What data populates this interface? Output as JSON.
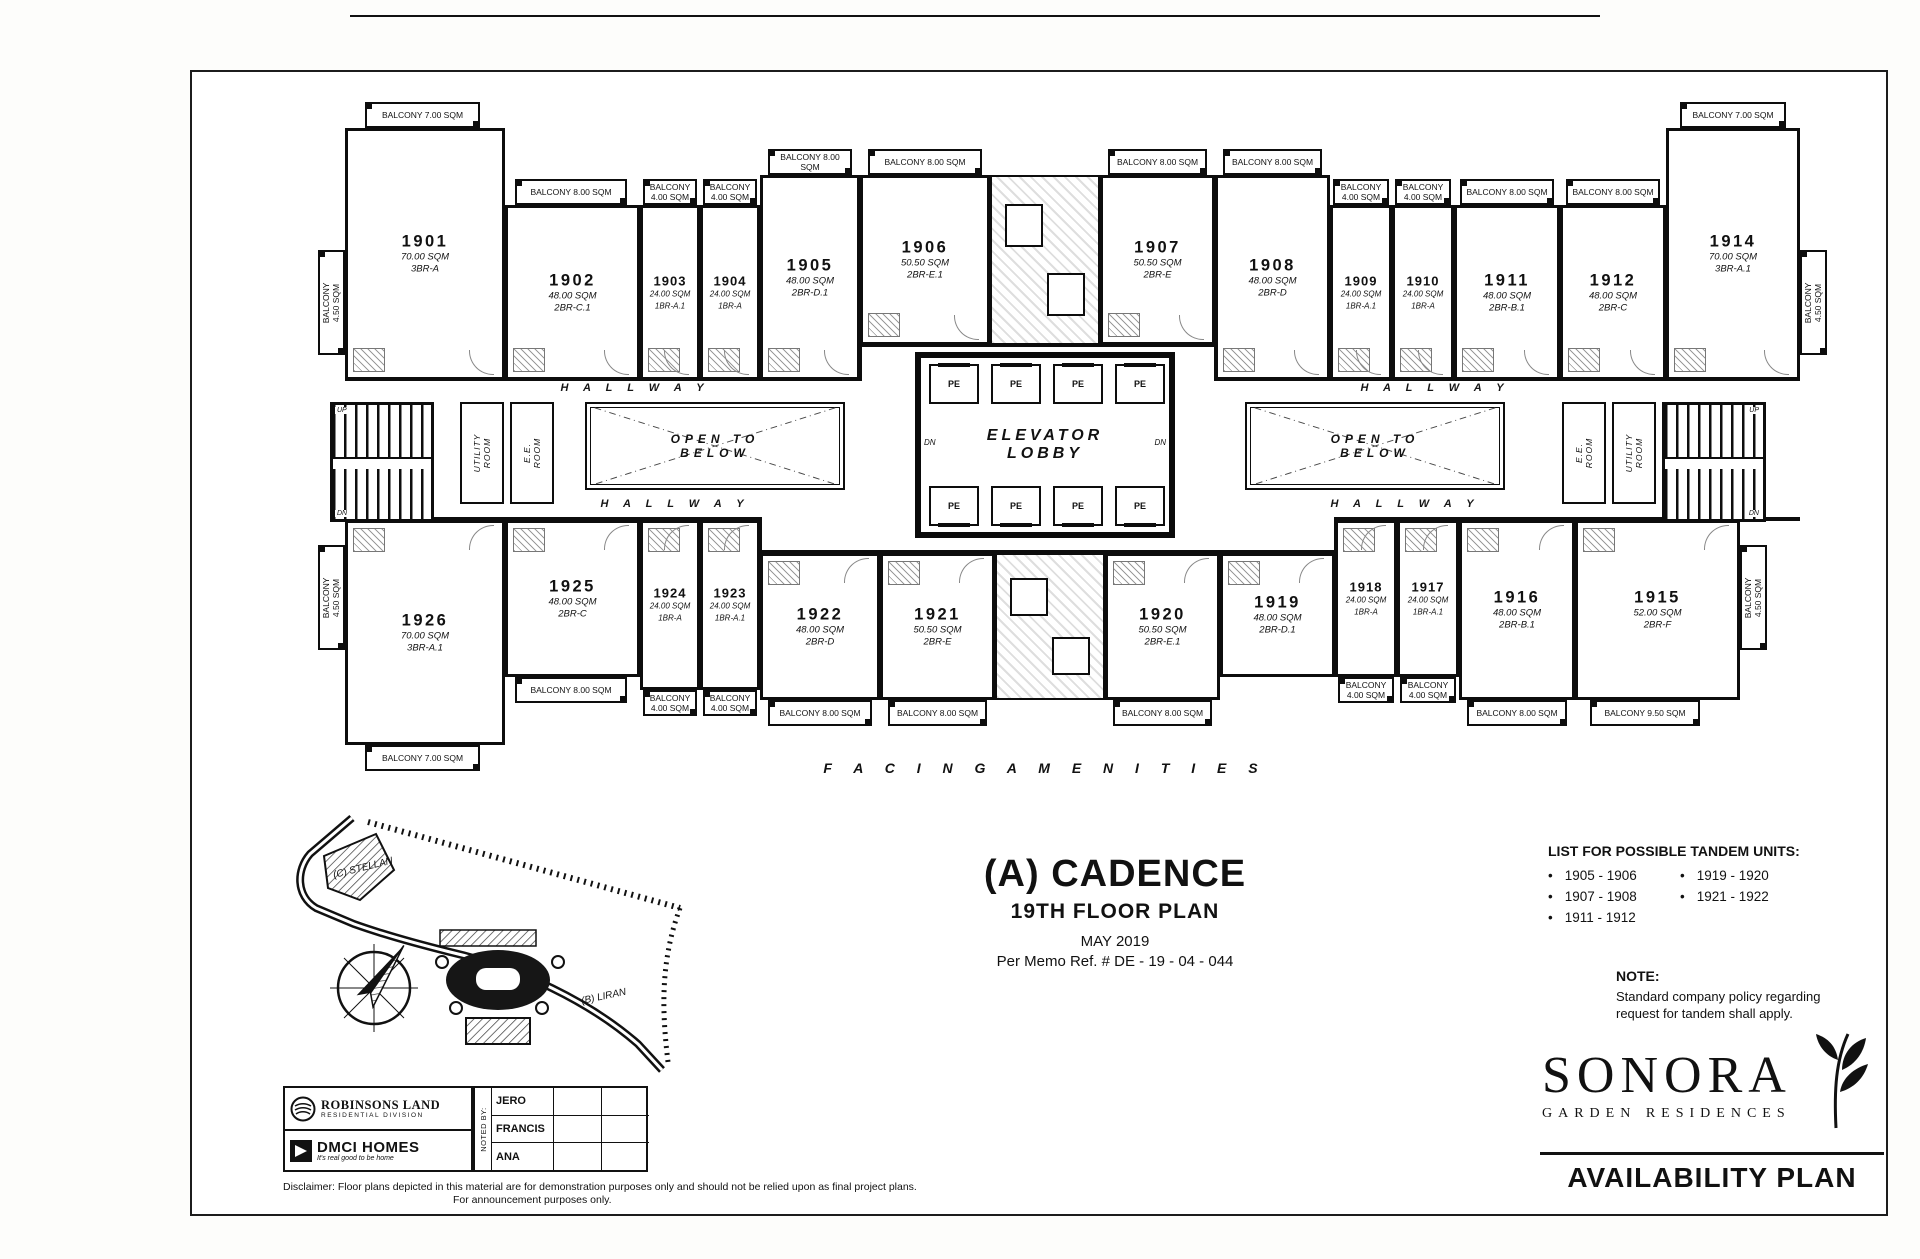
{
  "plan": {
    "labels": {
      "hallway": "H A L L W A Y",
      "open_to_below": "OPEN TO\nBELOW",
      "elevator_lobby": "ELEVATOR\nLOBBY",
      "pe": "PE",
      "dn": "DN",
      "up": "UP",
      "utility": "UTILITY\nROOM",
      "ee": "E.E.\nROOM",
      "facing": "F A C I N G   A M E N I T I E S"
    },
    "units": [
      {
        "number": "1901",
        "area": "70.00 SQM",
        "type": "3BR-A"
      },
      {
        "number": "1902",
        "area": "48.00 SQM",
        "type": "2BR-C.1"
      },
      {
        "number": "1903",
        "area": "24.00 SQM",
        "type": "1BR-A.1"
      },
      {
        "number": "1904",
        "area": "24.00 SQM",
        "type": "1BR-A"
      },
      {
        "number": "1905",
        "area": "48.00 SQM",
        "type": "2BR-D.1"
      },
      {
        "number": "1906",
        "area": "50.50 SQM",
        "type": "2BR-E.1"
      },
      {
        "number": "1907",
        "area": "50.50 SQM",
        "type": "2BR-E"
      },
      {
        "number": "1908",
        "area": "48.00 SQM",
        "type": "2BR-D"
      },
      {
        "number": "1909",
        "area": "24.00 SQM",
        "type": "1BR-A.1"
      },
      {
        "number": "1910",
        "area": "24.00 SQM",
        "type": "1BR-A"
      },
      {
        "number": "1911",
        "area": "48.00 SQM",
        "type": "2BR-B.1"
      },
      {
        "number": "1912",
        "area": "48.00 SQM",
        "type": "2BR-C"
      },
      {
        "number": "1914",
        "area": "70.00 SQM",
        "type": "3BR-A.1"
      },
      {
        "number": "1926",
        "area": "70.00 SQM",
        "type": "3BR-A.1"
      },
      {
        "number": "1925",
        "area": "48.00 SQM",
        "type": "2BR-C"
      },
      {
        "number": "1924",
        "area": "24.00 SQM",
        "type": "1BR-A"
      },
      {
        "number": "1923",
        "area": "24.00 SQM",
        "type": "1BR-A.1"
      },
      {
        "number": "1922",
        "area": "48.00 SQM",
        "type": "2BR-D"
      },
      {
        "number": "1921",
        "area": "50.50 SQM",
        "type": "2BR-E"
      },
      {
        "number": "1920",
        "area": "50.50 SQM",
        "type": "2BR-E.1"
      },
      {
        "number": "1919",
        "area": "48.00 SQM",
        "type": "2BR-D.1"
      },
      {
        "number": "1918",
        "area": "24.00 SQM",
        "type": "1BR-A"
      },
      {
        "number": "1917",
        "area": "24.00 SQM",
        "type": "1BR-A.1"
      },
      {
        "number": "1916",
        "area": "48.00 SQM",
        "type": "2BR-B.1"
      },
      {
        "number": "1915",
        "area": "52.00 SQM",
        "type": "2BR-F"
      }
    ],
    "balconies": [
      "BALCONY 7.00 SQM",
      "BALCONY 8.00 SQM",
      "BALCONY 4.00 SQM",
      "BALCONY 4.00 SQM",
      "BALCONY 8.00 SQM",
      "BALCONY 8.00 SQM",
      "BALCONY 8.00 SQM",
      "BALCONY 8.00 SQM",
      "BALCONY 4.00 SQM",
      "BALCONY 4.00 SQM",
      "BALCONY 8.00 SQM",
      "BALCONY 8.00 SQM",
      "BALCONY 7.00 SQM",
      "BALCONY 4.50 SQM",
      "BALCONY 4.50 SQM",
      "BALCONY 4.50 SQM",
      "BALCONY 4.50 SQM",
      "BALCONY 7.00 SQM",
      "BALCONY 8.00 SQM",
      "BALCONY 4.00 SQM",
      "BALCONY 4.00 SQM",
      "BALCONY 8.00 SQM",
      "BALCONY 8.00 SQM",
      "BALCONY 8.00 SQM",
      "BALCONY 4.00 SQM",
      "BALCONY 4.00 SQM",
      "BALCONY 8.00 SQM",
      "BALCONY 9.50 SQM"
    ]
  },
  "site_map": {
    "stellan": "(C) STELLAN",
    "liran": "(B) LIRAN"
  },
  "title_block": {
    "title": "(A) CADENCE",
    "subtitle": "19TH FLOOR PLAN",
    "date": "MAY 2019",
    "memo": "Per Memo Ref. # DE - 19 - 04 - 044"
  },
  "tandem": {
    "header": "LIST FOR POSSIBLE TANDEM UNITS:",
    "col1": [
      "1905 - 1906",
      "1907 - 1908",
      "1911 - 1912"
    ],
    "col2": [
      "1919 - 1920",
      "1921 - 1922"
    ],
    "note_label": "NOTE:",
    "note_text": "Standard company policy regarding request for tandem shall apply."
  },
  "branding": {
    "sonora": "SONORA",
    "sonora_sub": "GARDEN RESIDENCES",
    "availability": "AVAILABILITY PLAN",
    "robinsons": "ROBINSONS LAND",
    "robinsons_sub": "RESIDENTIAL DIVISION",
    "dmci": "DMCI HOMES",
    "dmci_tagline": "It's real good to be home"
  },
  "noted_by": {
    "label": "NOTED BY:",
    "names": [
      "JERO",
      "FRANCIS",
      "ANA"
    ]
  },
  "disclaimer": {
    "line1": "Disclaimer:  Floor plans depicted in this material are for demonstration purposes only and should not be relied upon as final project plans.",
    "line2": "For announcement purposes only."
  }
}
